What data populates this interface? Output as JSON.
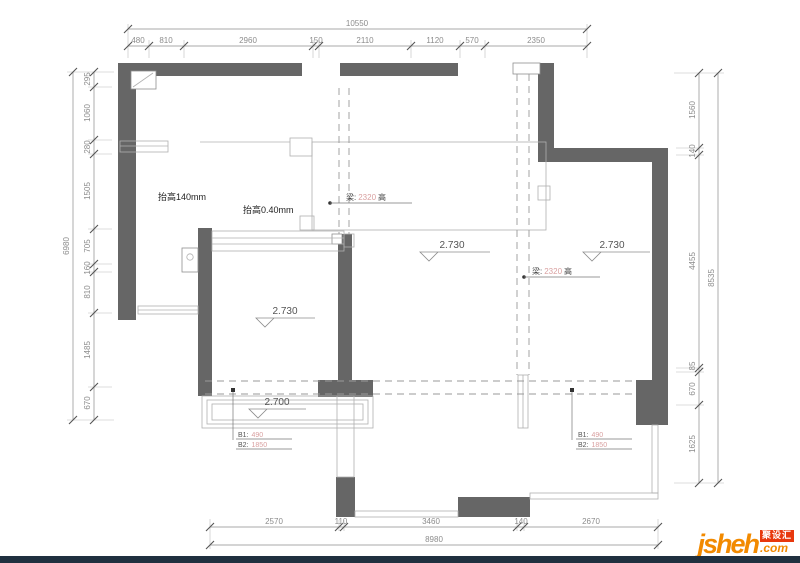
{
  "dimensions": {
    "top": {
      "total": "10550",
      "segments": [
        "480",
        "810",
        "2960",
        "150",
        "2110",
        "1120",
        "570",
        "2350"
      ]
    },
    "left": {
      "total": "6980",
      "segments": [
        "295",
        "1060",
        "280",
        "1505",
        "705",
        "160",
        "810",
        "1485",
        "670"
      ]
    },
    "right": {
      "total": "8535",
      "segments": [
        "1560",
        "140",
        "4455",
        "85",
        "670",
        "1625"
      ]
    },
    "bottom": {
      "total": "8980",
      "segments": [
        "2570",
        "110",
        "3460",
        "140",
        "2670"
      ]
    }
  },
  "annotations": {
    "raise_left": "抬高140mm",
    "raise_center": "抬高0.40mm",
    "beams": [
      {
        "prefix": "梁:",
        "value": "2320",
        "suffix": "高"
      },
      {
        "prefix": "梁:",
        "value": "2320",
        "suffix": "高"
      }
    ],
    "levels": [
      "2.730",
      "2.730",
      "2.730",
      "2.700"
    ],
    "window_tags": [
      {
        "label1": "B1:",
        "value1": "490",
        "label2": "B2:",
        "value2": "1850"
      },
      {
        "label1": "B1:",
        "value1": "490",
        "label2": "B2:",
        "value2": "1850"
      }
    ]
  },
  "logo": {
    "brand": "jsheh",
    "tld": ".com",
    "badge": "聚设汇"
  },
  "colors": {
    "wall": "#666666",
    "dimension_text": "#8c8c8c",
    "accent_value": "#d9a0a0",
    "logo_orange": "#f28a00",
    "logo_red": "#e8380d",
    "footer_bar": "#20303f"
  }
}
